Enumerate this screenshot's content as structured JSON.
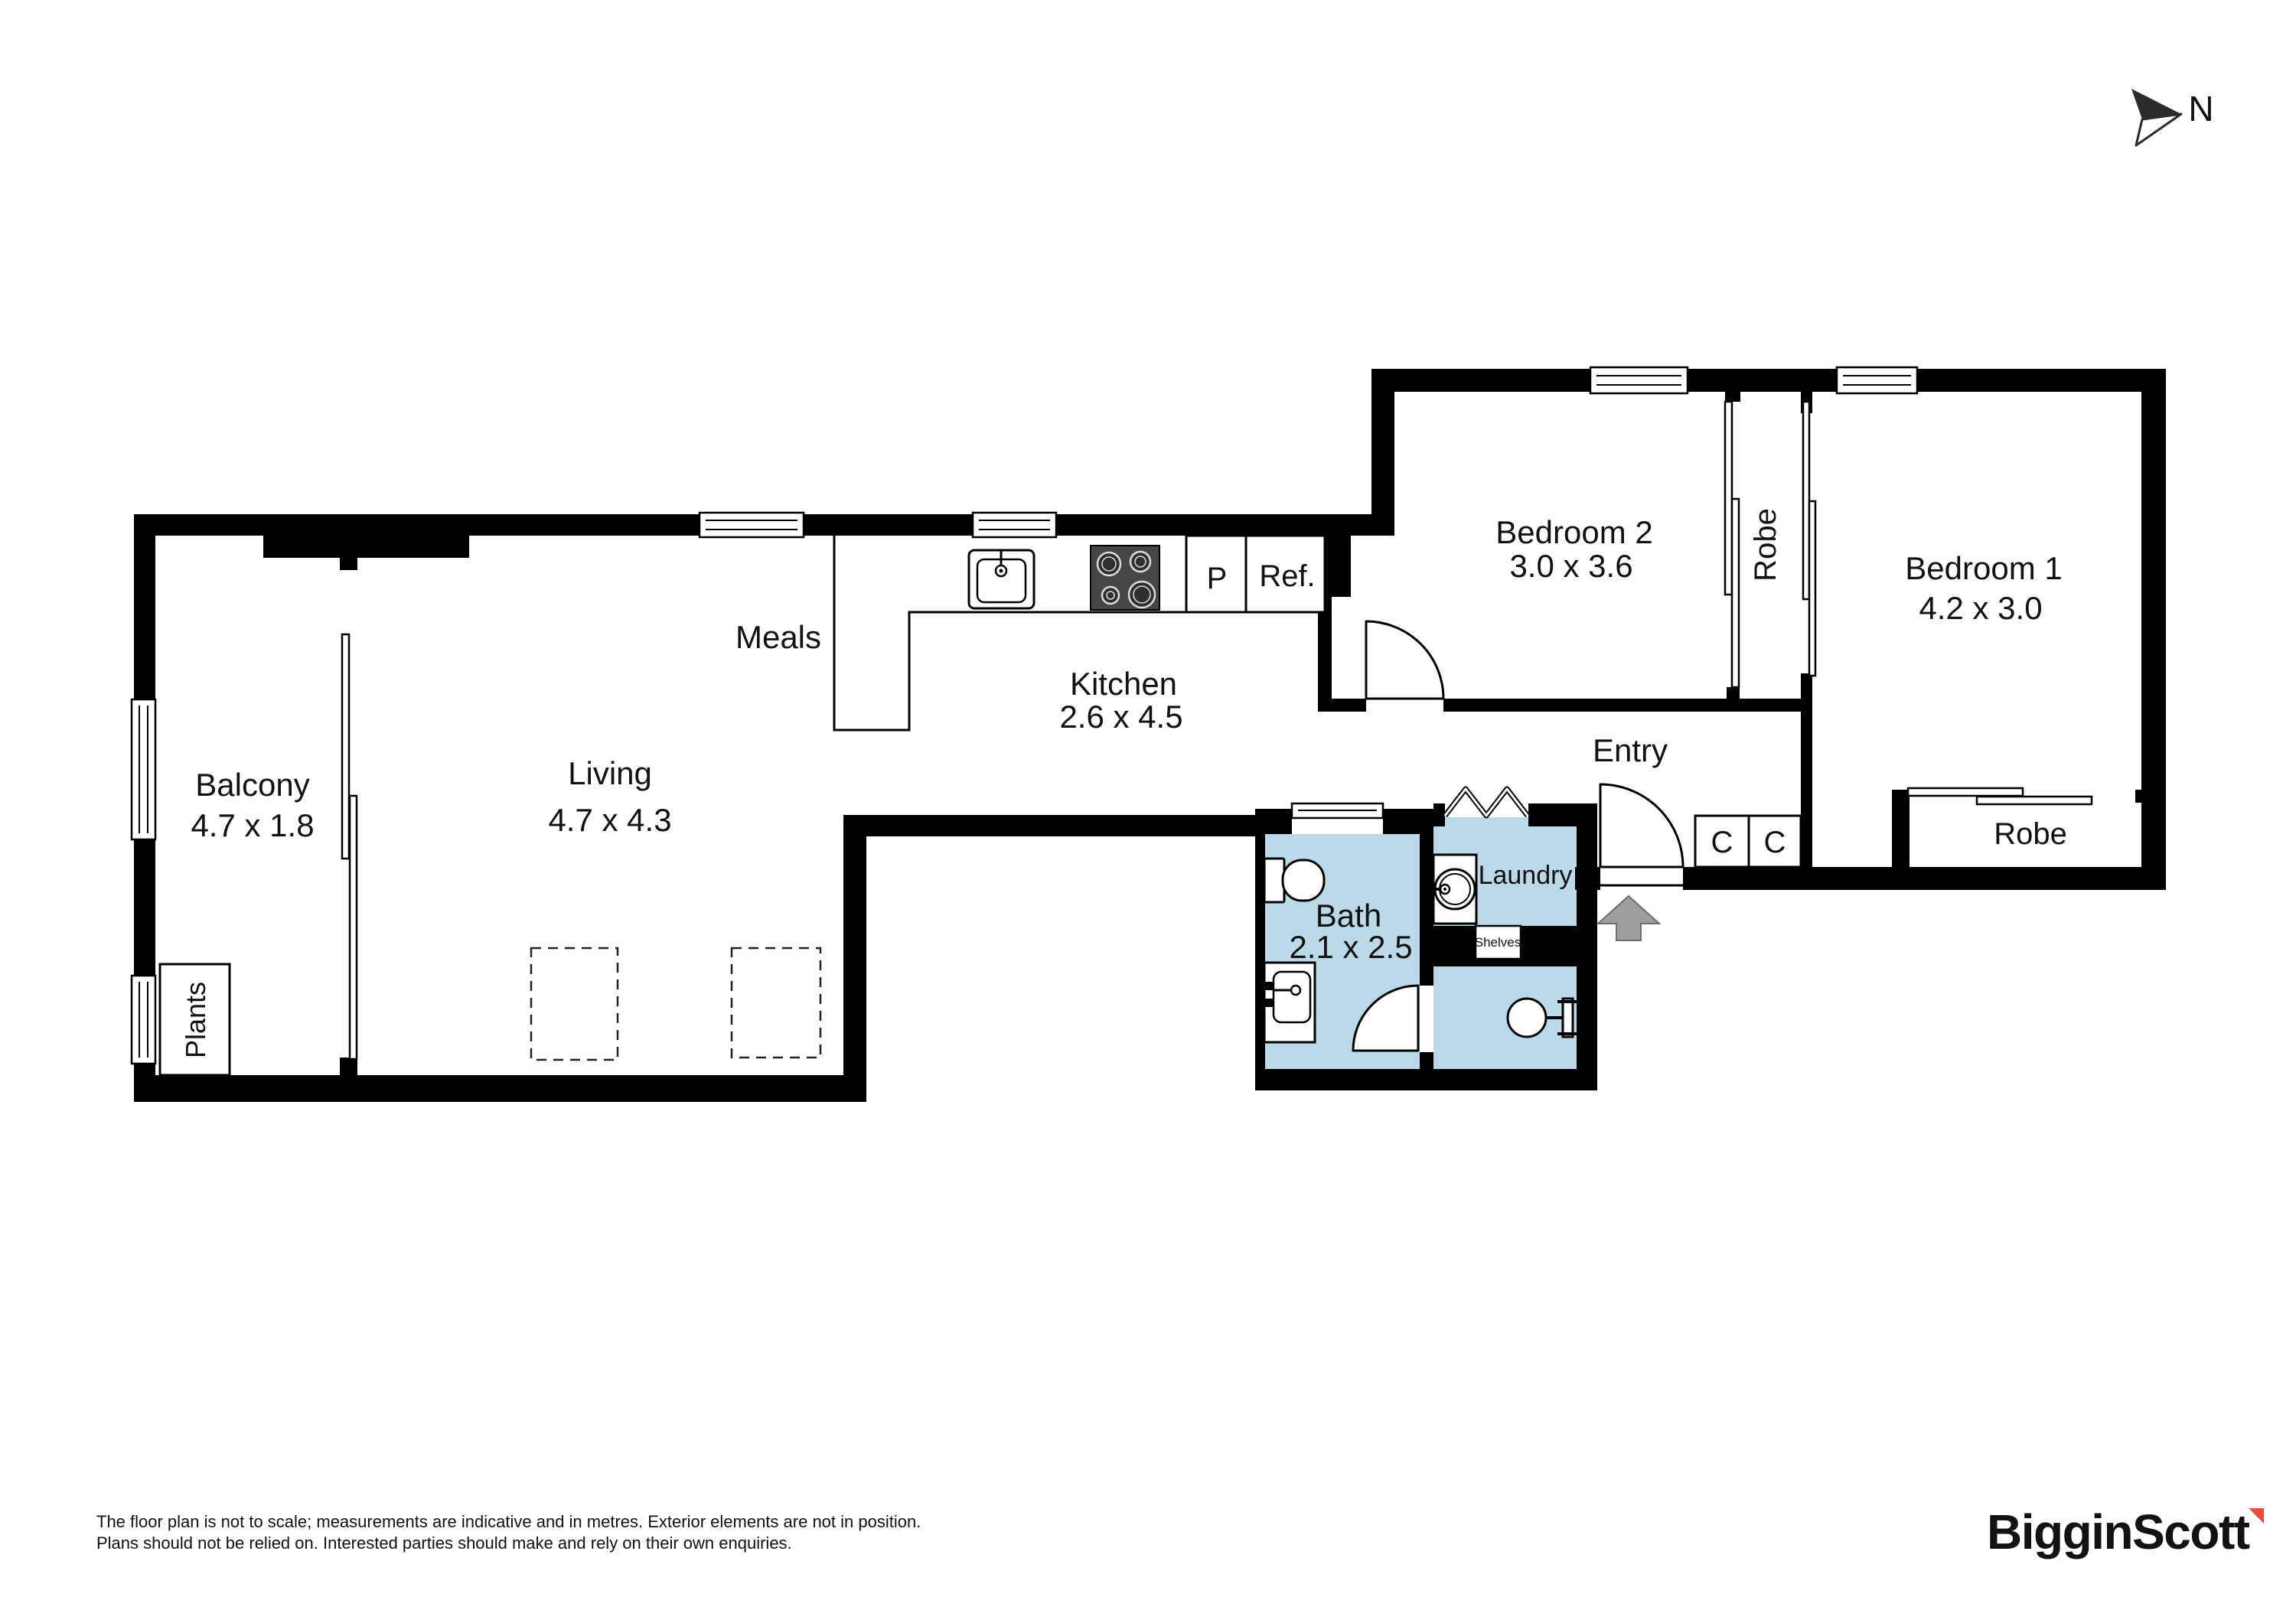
{
  "compass": {
    "north_label": "N"
  },
  "rooms": {
    "balcony": {
      "label": "Balcony",
      "dimensions": "4.7 x 1.8"
    },
    "living": {
      "label": "Living",
      "dimensions": "4.7 x 4.3"
    },
    "meals": {
      "label": "Meals"
    },
    "kitchen": {
      "label": "Kitchen",
      "dimensions": "2.6 x 4.5"
    },
    "bedroom2": {
      "label": "Bedroom 2",
      "dimensions": "3.0 x 3.6"
    },
    "bedroom1": {
      "label": "Bedroom 1",
      "dimensions": "4.2 x 3.0"
    },
    "bath": {
      "label": "Bath",
      "dimensions": "2.1 x 2.5"
    },
    "laundry": {
      "label": "Laundry"
    },
    "entry": {
      "label": "Entry"
    }
  },
  "features": {
    "robe_bedroom2": {
      "label": "Robe"
    },
    "robe_bedroom1": {
      "label": "Robe"
    },
    "plants": {
      "label": "Plants"
    },
    "shelves": {
      "label": "Shelves"
    },
    "pantry": {
      "label": "P"
    },
    "refrigerator": {
      "label": "Ref."
    },
    "cupboard_left": {
      "label": "C"
    },
    "cupboard_right": {
      "label": "C"
    }
  },
  "disclaimer": {
    "line1": "The floor plan is not to scale; measurements are indicative and in metres. Exterior elements are not in position.",
    "line2": "Plans should not be relied on. Interested parties should make and rely on their own enquiries."
  },
  "branding": {
    "agency_name": "BigginScott"
  },
  "colors": {
    "wall_black": "#000000",
    "wet_area_blue": "#bcd9e9",
    "entry_arrow_gray": "#9e9e9e",
    "logo_navy": "#1c2b3a",
    "logo_red": "#ef4b3c",
    "disclaimer_gray": "#a6a6a6"
  }
}
